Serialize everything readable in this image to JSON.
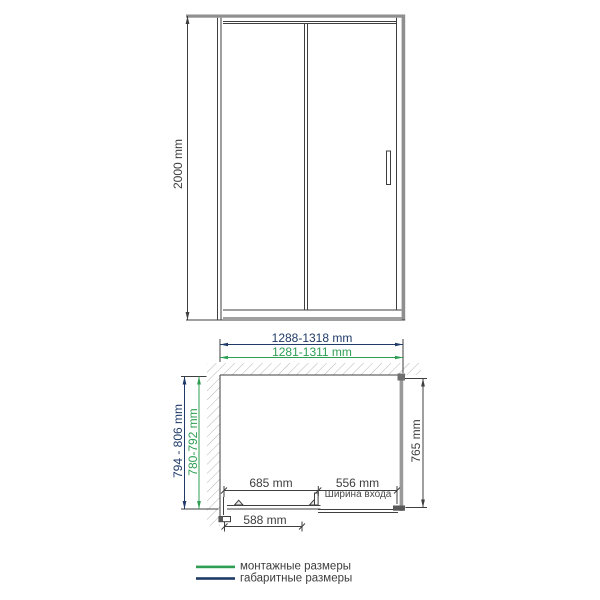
{
  "title": "Shower enclosure dimension drawing",
  "colors": {
    "mounting_green": "#2E9E52",
    "overall_navy": "#1F3A68",
    "line_dark": "#3f3f3f",
    "profile_gray": "#8f8f8f"
  },
  "front_view": {
    "height": "2000 mm"
  },
  "plan_view": {
    "overall_width": "1288-1318 mm",
    "mounting_width": "1281-1311 mm",
    "overall_depth": "794 - 806 mm",
    "mounting_depth": "780-792 mm",
    "side_depth": "765 mm",
    "door_travel": "685 mm",
    "entry_width": "556 mm",
    "entry_width_caption": "Ширина входа",
    "door_width": "588 mm"
  },
  "legend": {
    "mounting": {
      "label": "монтажные размеры",
      "color": "#2E9E52"
    },
    "overall": {
      "label": "габаритные размеры",
      "color": "#1F3A68"
    }
  }
}
